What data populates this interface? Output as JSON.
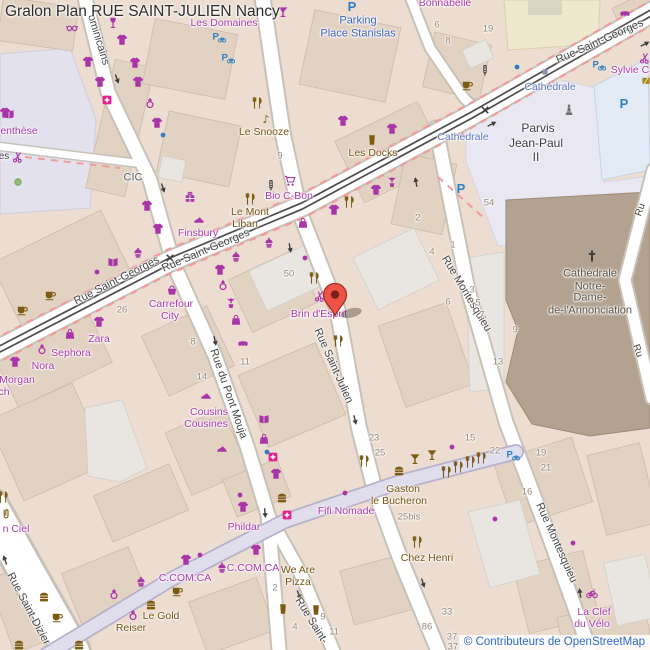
{
  "title": "Gralon Plan RUE SAINT-JULIEN Nancy",
  "attribution": "© Contributeurs de OpenStreetMap",
  "marker": {
    "label": "selected-location",
    "x": 335,
    "y": 303
  },
  "palette": {
    "street": "#454545",
    "transit": "#5b74c4",
    "parking": "#3f63c4",
    "place": "#3d3d49",
    "cath": "#5a5146",
    "shop": "#ab39ab",
    "food": "#775310",
    "bank": "#5a5a64",
    "hnum": "#96887a",
    "shopIcon": "#a936a9",
    "foodIcon": "#7c5a12",
    "blueIcon": "#2e7ec6",
    "darkIcon": "#3e3e3e",
    "grayIcon": "#8f8fa8",
    "greenIcon": "#8fbf78",
    "goldIcon": "#a5841a",
    "pinkIcon": "#df2490",
    "statueIcon": "#6f6f6f",
    "markerFill": "#ee5347",
    "markerStroke": "#9a2e23",
    "tram": "#4c4c4c",
    "busRoute": "#ef9c9c",
    "attributionLink": "#2f6bc8"
  },
  "labels": {
    "streets": [
      {
        "t": "Rue Saint-Georges",
        "x": 117,
        "y": 281,
        "r": -27
      },
      {
        "t": "Rue Saint-Georges",
        "x": 206,
        "y": 251,
        "r": -23
      },
      {
        "t": "Rue Saint-Georges",
        "x": 600,
        "y": 42,
        "r": -24
      },
      {
        "t": "Rue Saint-Julien",
        "x": 333,
        "y": 366,
        "r": 66
      },
      {
        "t": "Rue Saint-",
        "x": 311,
        "y": 621,
        "r": 58
      },
      {
        "t": "Rue du Pont Mouja",
        "x": 228,
        "y": 394,
        "r": 71
      },
      {
        "t": "Rue Montesquieu",
        "x": 466,
        "y": 294,
        "r": 59
      },
      {
        "t": "Rue Montesquieu",
        "x": 556,
        "y": 543,
        "r": 66
      },
      {
        "t": "Rue Saint-Dizier",
        "x": 28,
        "y": 609,
        "r": 62
      },
      {
        "t": "ominicains",
        "x": 98,
        "y": 40,
        "r": 73
      },
      {
        "t": "Ru",
        "x": 641,
        "y": 210,
        "r": -70,
        "s": 10
      },
      {
        "t": "Ru",
        "x": 637,
        "y": 351,
        "r": 70,
        "s": 10
      }
    ],
    "transit": [
      {
        "t": "Cathédrale",
        "x": 463,
        "y": 137
      },
      {
        "t": "Cathédrale",
        "x": 550,
        "y": 87
      }
    ],
    "places": [
      {
        "t": "Parking",
        "x": 358,
        "y": 21,
        "c": "parking"
      },
      {
        "t": "Place Stanislas",
        "x": 358,
        "y": 34,
        "c": "parking"
      },
      {
        "t": "Parvis",
        "x": 538,
        "y": 128,
        "c": "place",
        "s": 12
      },
      {
        "t": "Jean-Paul",
        "x": 536,
        "y": 143,
        "c": "place",
        "s": 12
      },
      {
        "t": "II",
        "x": 536,
        "y": 157,
        "c": "place",
        "s": 12
      },
      {
        "t": "Cathédrale",
        "x": 590,
        "y": 274,
        "c": "cath"
      },
      {
        "t": "Notre-",
        "x": 590,
        "y": 287,
        "c": "cath"
      },
      {
        "t": "Dame-",
        "x": 590,
        "y": 298,
        "c": "cath"
      },
      {
        "t": "de-l'Annonciation",
        "x": 590,
        "y": 311,
        "c": "cath"
      },
      {
        "t": "es",
        "x": 4,
        "y": 157,
        "c": "place",
        "s": 10
      },
      {
        "t": "CIC",
        "x": 133,
        "y": 178,
        "c": "bank"
      }
    ],
    "shops": [
      {
        "t": "Les Domaines",
        "x": 224,
        "y": 23
      },
      {
        "t": "Bonnabelle",
        "x": 445,
        "y": 3
      },
      {
        "t": "Sylvie C",
        "x": 630,
        "y": 70
      },
      {
        "t": "enthèse",
        "x": 19,
        "y": 131
      },
      {
        "t": "Bio C-Bon",
        "x": 289,
        "y": 196
      },
      {
        "t": "Finsbury",
        "x": 198,
        "y": 233
      },
      {
        "t": "Carrefour",
        "x": 171,
        "y": 304
      },
      {
        "t": "City",
        "x": 170,
        "y": 316
      },
      {
        "t": "Zara",
        "x": 99,
        "y": 339
      },
      {
        "t": "Sephora",
        "x": 71,
        "y": 353
      },
      {
        "t": "Nora",
        "x": 43,
        "y": 366
      },
      {
        "t": "Morgan",
        "x": 17,
        "y": 380
      },
      {
        "t": "ch",
        "x": 4,
        "y": 392
      },
      {
        "t": "Cousins",
        "x": 209,
        "y": 412
      },
      {
        "t": "Cousines",
        "x": 206,
        "y": 424
      },
      {
        "t": "Brin d'Esprit",
        "x": 319,
        "y": 314
      },
      {
        "t": "Fifi Nomade",
        "x": 346,
        "y": 511
      },
      {
        "t": "Phildar",
        "x": 244,
        "y": 527
      },
      {
        "t": "C.COM.CA",
        "x": 253,
        "y": 568
      },
      {
        "t": "C.COM.CA",
        "x": 185,
        "y": 578
      },
      {
        "t": "n Ciel",
        "x": 16,
        "y": 529
      },
      {
        "t": "La Clef",
        "x": 594,
        "y": 612
      },
      {
        "t": "du Vélo",
        "x": 592,
        "y": 624
      }
    ],
    "food": [
      {
        "t": "Le Snooze",
        "x": 264,
        "y": 132
      },
      {
        "t": "Les Docks",
        "x": 373,
        "y": 153
      },
      {
        "t": "Le Mont",
        "x": 250,
        "y": 212
      },
      {
        "t": "Liban",
        "x": 245,
        "y": 224
      },
      {
        "t": "Gaston",
        "x": 403,
        "y": 489
      },
      {
        "t": "le Bucheron",
        "x": 399,
        "y": 501
      },
      {
        "t": "Chez Henri",
        "x": 427,
        "y": 558
      },
      {
        "t": "We Are",
        "x": 298,
        "y": 570
      },
      {
        "t": "Pizza",
        "x": 298,
        "y": 582
      },
      {
        "t": "Le Gold",
        "x": 161,
        "y": 616
      },
      {
        "t": "Reiser",
        "x": 131,
        "y": 628
      }
    ],
    "house_numbers": [
      {
        "t": "9",
        "x": 280,
        "y": 156
      },
      {
        "t": "6",
        "x": 437,
        "y": 25
      },
      {
        "t": "8",
        "x": 448,
        "y": 41
      },
      {
        "t": "19",
        "x": 488,
        "y": 29
      },
      {
        "t": "54",
        "x": 489,
        "y": 203
      },
      {
        "t": "2",
        "x": 418,
        "y": 218
      },
      {
        "t": "4",
        "x": 432,
        "y": 252
      },
      {
        "t": "1",
        "x": 453,
        "y": 245
      },
      {
        "t": "3",
        "x": 472,
        "y": 290
      },
      {
        "t": "6",
        "x": 448,
        "y": 302
      },
      {
        "t": "5",
        "x": 478,
        "y": 303
      },
      {
        "t": "7",
        "x": 482,
        "y": 315
      },
      {
        "t": "9",
        "x": 515,
        "y": 330
      },
      {
        "t": "13",
        "x": 498,
        "y": 362
      },
      {
        "t": "50",
        "x": 289,
        "y": 274
      },
      {
        "t": "26",
        "x": 122,
        "y": 310
      },
      {
        "t": "8",
        "x": 193,
        "y": 342
      },
      {
        "t": "14",
        "x": 202,
        "y": 377
      },
      {
        "t": "11",
        "x": 245,
        "y": 362
      },
      {
        "t": "23",
        "x": 374,
        "y": 438
      },
      {
        "t": "25",
        "x": 380,
        "y": 453
      },
      {
        "t": "25bis",
        "x": 409,
        "y": 517
      },
      {
        "t": "15",
        "x": 470,
        "y": 438
      },
      {
        "t": "22",
        "x": 495,
        "y": 451
      },
      {
        "t": "19",
        "x": 541,
        "y": 453
      },
      {
        "t": "21",
        "x": 546,
        "y": 468
      },
      {
        "t": "16",
        "x": 527,
        "y": 492
      },
      {
        "t": "33",
        "x": 447,
        "y": 612
      },
      {
        "t": "86",
        "x": 427,
        "y": 627
      },
      {
        "t": "37",
        "x": 452,
        "y": 637
      },
      {
        "t": "37bis",
        "x": 459,
        "y": 647
      },
      {
        "t": "2",
        "x": 275,
        "y": 588
      },
      {
        "t": "4",
        "x": 295,
        "y": 627
      },
      {
        "t": "9",
        "x": 323,
        "y": 617
      },
      {
        "t": "11",
        "x": 334,
        "y": 632
      }
    ]
  },
  "icons": [
    {
      "t": "tshirt",
      "x": 122,
      "y": 40,
      "c": "shopIcon"
    },
    {
      "t": "tshirt",
      "x": 88,
      "y": 62,
      "c": "shopIcon"
    },
    {
      "t": "tshirt",
      "x": 135,
      "y": 63,
      "c": "shopIcon"
    },
    {
      "t": "tshirt",
      "x": 100,
      "y": 82,
      "c": "shopIcon"
    },
    {
      "t": "tshirt",
      "x": 138,
      "y": 82,
      "c": "shopIcon"
    },
    {
      "t": "tshirt",
      "x": 157,
      "y": 123,
      "c": "shopIcon"
    },
    {
      "t": "tshirt",
      "x": 147,
      "y": 206,
      "c": "shopIcon"
    },
    {
      "t": "tshirt",
      "x": 158,
      "y": 229,
      "c": "shopIcon"
    },
    {
      "t": "tshirt",
      "x": 220,
      "y": 270,
      "c": "shopIcon"
    },
    {
      "t": "tshirt",
      "x": 99,
      "y": 322,
      "c": "shopIcon"
    },
    {
      "t": "tshirt",
      "x": 15,
      "y": 362,
      "c": "shopIcon"
    },
    {
      "t": "tshirt",
      "x": 334,
      "y": 210,
      "c": "shopIcon"
    },
    {
      "t": "tshirt",
      "x": 376,
      "y": 190,
      "c": "shopIcon"
    },
    {
      "t": "tshirt",
      "x": 392,
      "y": 129,
      "c": "shopIcon"
    },
    {
      "t": "tshirt",
      "x": 243,
      "y": 507,
      "c": "shopIcon"
    },
    {
      "t": "tshirt",
      "x": 186,
      "y": 560,
      "c": "shopIcon"
    },
    {
      "t": "tshirt",
      "x": 256,
      "y": 550,
      "c": "shopIcon"
    },
    {
      "t": "tshirt",
      "x": 276,
      "y": 474,
      "c": "shopIcon"
    },
    {
      "t": "tshirt",
      "x": 343,
      "y": 121,
      "c": "shopIcon"
    },
    {
      "t": "tshirt",
      "x": 5,
      "y": 113,
      "c": "shopIcon"
    },
    {
      "t": "glasses",
      "x": 72,
      "y": 28,
      "c": "shopIcon"
    },
    {
      "t": "wineglass",
      "x": 113,
      "y": 23,
      "c": "shopIcon"
    },
    {
      "t": "cocktail",
      "x": 283,
      "y": 12,
      "c": "shopIcon"
    },
    {
      "t": "pharmacy",
      "x": 107,
      "y": 100,
      "c": "pinkIcon"
    },
    {
      "t": "pharmacy",
      "x": 287,
      "y": 515,
      "c": "pinkIcon"
    },
    {
      "t": "pharmacy",
      "x": 273,
      "y": 457,
      "c": "pinkIcon"
    },
    {
      "t": "book",
      "x": 9,
      "y": 114,
      "c": "shopIcon"
    },
    {
      "t": "book",
      "x": 113,
      "y": 262,
      "c": "shopIcon"
    },
    {
      "t": "book",
      "x": 264,
      "y": 419,
      "c": "shopIcon"
    },
    {
      "t": "scissors",
      "x": 18,
      "y": 157,
      "c": "shopIcon"
    },
    {
      "t": "scissors",
      "x": 320,
      "y": 296,
      "c": "shopIcon"
    },
    {
      "t": "scissors",
      "x": 645,
      "y": 58,
      "c": "shopIcon"
    },
    {
      "t": "ring",
      "x": 150,
      "y": 103,
      "c": "shopIcon"
    },
    {
      "t": "ring",
      "x": 223,
      "y": 285,
      "c": "shopIcon"
    },
    {
      "t": "ring",
      "x": 42,
      "y": 349,
      "c": "shopIcon"
    },
    {
      "t": "ring",
      "x": 114,
      "y": 594,
      "c": "shopIcon"
    },
    {
      "t": "ring",
      "x": 133,
      "y": 615,
      "c": "shopIcon"
    },
    {
      "t": "sweet",
      "x": 138,
      "y": 253,
      "c": "shopIcon"
    },
    {
      "t": "sweet",
      "x": 269,
      "y": 243,
      "c": "shopIcon"
    },
    {
      "t": "sweet",
      "x": 236,
      "y": 257,
      "c": "shopIcon"
    },
    {
      "t": "sweet",
      "x": 141,
      "y": 582,
      "c": "shopIcon"
    },
    {
      "t": "sweet",
      "x": 222,
      "y": 568,
      "c": "shopIcon"
    },
    {
      "t": "flower",
      "x": 392,
      "y": 182,
      "c": "shopIcon"
    },
    {
      "t": "flower",
      "x": 231,
      "y": 303,
      "c": "shopIcon"
    },
    {
      "t": "cart",
      "x": 290,
      "y": 181,
      "c": "shopIcon"
    },
    {
      "t": "basket",
      "x": 172,
      "y": 290,
      "c": "shopIcon"
    },
    {
      "t": "gift",
      "x": 190,
      "y": 197,
      "c": "shopIcon"
    },
    {
      "t": "shoe",
      "x": 199,
      "y": 219,
      "c": "shopIcon"
    },
    {
      "t": "shoe",
      "x": 206,
      "y": 395,
      "c": "shopIcon"
    },
    {
      "t": "shoe",
      "x": 222,
      "y": 448,
      "c": "shopIcon"
    },
    {
      "t": "bag",
      "x": 70,
      "y": 334,
      "c": "shopIcon"
    },
    {
      "t": "bag",
      "x": 264,
      "y": 439,
      "c": "shopIcon"
    },
    {
      "t": "bag",
      "x": 303,
      "y": 223,
      "c": "shopIcon"
    },
    {
      "t": "bag",
      "x": 236,
      "y": 320,
      "c": "shopIcon"
    },
    {
      "t": "awning",
      "x": 243,
      "y": 345,
      "c": "shopIcon"
    },
    {
      "t": "awning",
      "x": 625,
      "y": 15,
      "c": "shopIcon"
    },
    {
      "t": "bike",
      "x": 592,
      "y": 593,
      "c": "shopIcon"
    },
    {
      "t": "clip",
      "x": 6,
      "y": 514,
      "c": "foodIcon"
    },
    {
      "t": "dot",
      "x": 97,
      "y": 272,
      "c": "shopIcon"
    },
    {
      "t": "dot",
      "x": 305,
      "y": 258,
      "c": "shopIcon"
    },
    {
      "t": "dot",
      "x": 200,
      "y": 555,
      "c": "shopIcon"
    },
    {
      "t": "dot",
      "x": 452,
      "y": 447,
      "c": "shopIcon"
    },
    {
      "t": "dot",
      "x": 495,
      "y": 519,
      "c": "shopIcon"
    },
    {
      "t": "dot",
      "x": 573,
      "y": 543,
      "c": "shopIcon"
    },
    {
      "t": "dot",
      "x": 345,
      "y": 493,
      "c": "shopIcon"
    },
    {
      "t": "dot",
      "x": 240,
      "y": 495,
      "c": "shopIcon"
    },
    {
      "t": "dot",
      "x": 517,
      "y": 67,
      "c": "blueIcon"
    },
    {
      "t": "dot",
      "x": 163,
      "y": 135,
      "c": "blueIcon"
    },
    {
      "t": "dot",
      "x": 267,
      "y": 452,
      "c": "blueIcon"
    },
    {
      "t": "tree",
      "x": 18,
      "y": 182,
      "c": "greenIcon"
    },
    {
      "t": "sq",
      "x": 545,
      "y": 72,
      "c": "grayIcon"
    },
    {
      "t": "goldsq",
      "x": 646,
      "y": 81,
      "c": "goldIcon"
    },
    {
      "t": "fork",
      "x": 257,
      "y": 103,
      "c": "foodIcon"
    },
    {
      "t": "fork",
      "x": 250,
      "y": 199,
      "c": "foodIcon"
    },
    {
      "t": "fork",
      "x": 349,
      "y": 202,
      "c": "foodIcon"
    },
    {
      "t": "fork",
      "x": 314,
      "y": 278,
      "c": "foodIcon"
    },
    {
      "t": "fork",
      "x": 338,
      "y": 341,
      "c": "foodIcon"
    },
    {
      "t": "fork",
      "x": 364,
      "y": 461,
      "c": "foodIcon"
    },
    {
      "t": "fork",
      "x": 417,
      "y": 542,
      "c": "foodIcon"
    },
    {
      "t": "fork",
      "x": 446,
      "y": 472,
      "c": "foodIcon"
    },
    {
      "t": "fork",
      "x": 458,
      "y": 467,
      "c": "foodIcon"
    },
    {
      "t": "fork",
      "x": 470,
      "y": 462,
      "c": "foodIcon"
    },
    {
      "t": "fork",
      "x": 481,
      "y": 458,
      "c": "foodIcon"
    },
    {
      "t": "fork",
      "x": 3,
      "y": 497,
      "c": "foodIcon"
    },
    {
      "t": "burger",
      "x": 44,
      "y": 597,
      "c": "foodIcon"
    },
    {
      "t": "burger",
      "x": 19,
      "y": 645,
      "c": "foodIcon"
    },
    {
      "t": "burger",
      "x": 79,
      "y": 645,
      "c": "foodIcon"
    },
    {
      "t": "burger",
      "x": 151,
      "y": 605,
      "c": "foodIcon"
    },
    {
      "t": "burger",
      "x": 282,
      "y": 498,
      "c": "foodIcon"
    },
    {
      "t": "burger",
      "x": 399,
      "y": 471,
      "c": "foodIcon"
    },
    {
      "t": "cup",
      "x": 50,
      "y": 295,
      "c": "foodIcon"
    },
    {
      "t": "cup",
      "x": 22,
      "y": 310,
      "c": "foodIcon"
    },
    {
      "t": "cup",
      "x": 177,
      "y": 591,
      "c": "foodIcon"
    },
    {
      "t": "cup",
      "x": 57,
      "y": 617,
      "c": "foodIcon"
    },
    {
      "t": "cup",
      "x": 467,
      "y": 85,
      "c": "foodIcon"
    },
    {
      "t": "beer",
      "x": 372,
      "y": 140,
      "c": "foodIcon"
    },
    {
      "t": "beer",
      "x": 283,
      "y": 609,
      "c": "foodIcon"
    },
    {
      "t": "beer",
      "x": 316,
      "y": 610,
      "c": "foodIcon"
    },
    {
      "t": "cocktail",
      "x": 415,
      "y": 459,
      "c": "foodIcon"
    },
    {
      "t": "cocktail",
      "x": 432,
      "y": 455,
      "c": "foodIcon"
    },
    {
      "t": "music",
      "x": 266,
      "y": 119,
      "c": "foodIcon"
    },
    {
      "t": "pbike",
      "x": 218,
      "y": 37,
      "c": "blueIcon"
    },
    {
      "t": "pbike",
      "x": 227,
      "y": 58,
      "c": "blueIcon"
    },
    {
      "t": "pbike",
      "x": 598,
      "y": 65,
      "c": "blueIcon"
    },
    {
      "t": "pbike",
      "x": 512,
      "y": 455,
      "c": "blueIcon"
    },
    {
      "t": "pcar",
      "x": 352,
      "y": 6,
      "c": "blueIcon"
    },
    {
      "t": "pcar",
      "x": 461,
      "y": 188,
      "c": "blueIcon"
    },
    {
      "t": "pcar",
      "x": 624,
      "y": 103,
      "c": "blueIcon"
    },
    {
      "t": "light",
      "x": 485,
      "y": 70,
      "c": "darkIcon"
    },
    {
      "t": "light",
      "x": 271,
      "y": 185,
      "c": "darkIcon"
    },
    {
      "t": "statue",
      "x": 569,
      "y": 110,
      "c": "statueIcon"
    },
    {
      "t": "cross",
      "x": 170,
      "y": 258,
      "c": "darkIcon"
    },
    {
      "t": "cross",
      "x": 485,
      "y": 110,
      "c": "darkIcon"
    },
    {
      "t": "cathcross",
      "x": 592,
      "y": 256,
      "c": "darkIcon"
    },
    {
      "t": "arrow",
      "x": 117,
      "y": 79,
      "r": -20,
      "c": "darkIcon"
    },
    {
      "t": "arrow",
      "x": 163,
      "y": 188,
      "r": -18,
      "c": "darkIcon"
    },
    {
      "t": "arrow",
      "x": 215,
      "y": 341,
      "r": -12,
      "c": "darkIcon"
    },
    {
      "t": "arrow",
      "x": 265,
      "y": 513,
      "r": -5,
      "c": "darkIcon"
    },
    {
      "t": "arrow",
      "x": 290,
      "y": 248,
      "r": -10,
      "c": "darkIcon"
    },
    {
      "t": "arrow",
      "x": 355,
      "y": 420,
      "r": -13,
      "c": "darkIcon"
    },
    {
      "t": "arrow",
      "x": 299,
      "y": 595,
      "r": -22,
      "c": "darkIcon"
    },
    {
      "t": "arrow",
      "x": 423,
      "y": 583,
      "r": -18,
      "c": "darkIcon"
    },
    {
      "t": "arrow",
      "x": 416,
      "y": 182,
      "r": 170,
      "c": "darkIcon"
    },
    {
      "t": "arrow",
      "x": 580,
      "y": 593,
      "r": 172,
      "c": "darkIcon"
    },
    {
      "t": "arrow",
      "x": 5,
      "y": 560,
      "r": 160,
      "c": "darkIcon"
    },
    {
      "t": "arrow",
      "x": 645,
      "y": 44,
      "r": -117,
      "c": "darkIcon"
    },
    {
      "t": "arrow",
      "x": 492,
      "y": 124,
      "r": -117,
      "c": "darkIcon"
    }
  ]
}
